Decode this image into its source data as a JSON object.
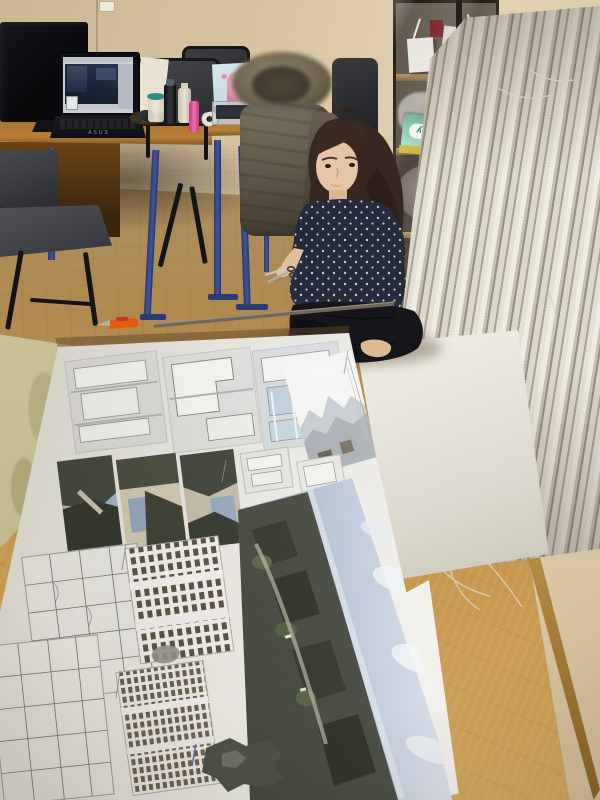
{
  "photo": {
    "kind": "indoor studio photograph",
    "labels": {
      "copy_box": "SvetoCopy",
      "laptop_brand": "ASUS"
    },
    "objects": [
      "desk-with-laptop",
      "computer-monitor",
      "office-chairs",
      "fur-hooded-parka",
      "girl-sitting-on-floor",
      "scissors",
      "utility-knife",
      "metal-ruler",
      "glass-display-cabinet",
      "architectural-models",
      "stacked-presentation-boards",
      "large-architecture-poster",
      "parquet-floor"
    ],
    "palette": {
      "wall": "#d8c5a3",
      "floor_back": "#b08a50",
      "floor_front": "#c99a53",
      "desk_wood": "#a96f2e",
      "table_leg_blue": "#44549c",
      "chair_grey": "#3c3d41",
      "parka_olive": "#5d5546",
      "hair_brown": "#362820",
      "skin": "#e7c6a8",
      "blouse_navy": "#252a3d",
      "skirt_black": "#15151a",
      "board_white": "#efece4",
      "poster_sheet": "#eceae4",
      "render_sky": "#aebdd3",
      "knife_orange": "#e8590f",
      "copy_box_green": "#7fc0a4"
    }
  }
}
